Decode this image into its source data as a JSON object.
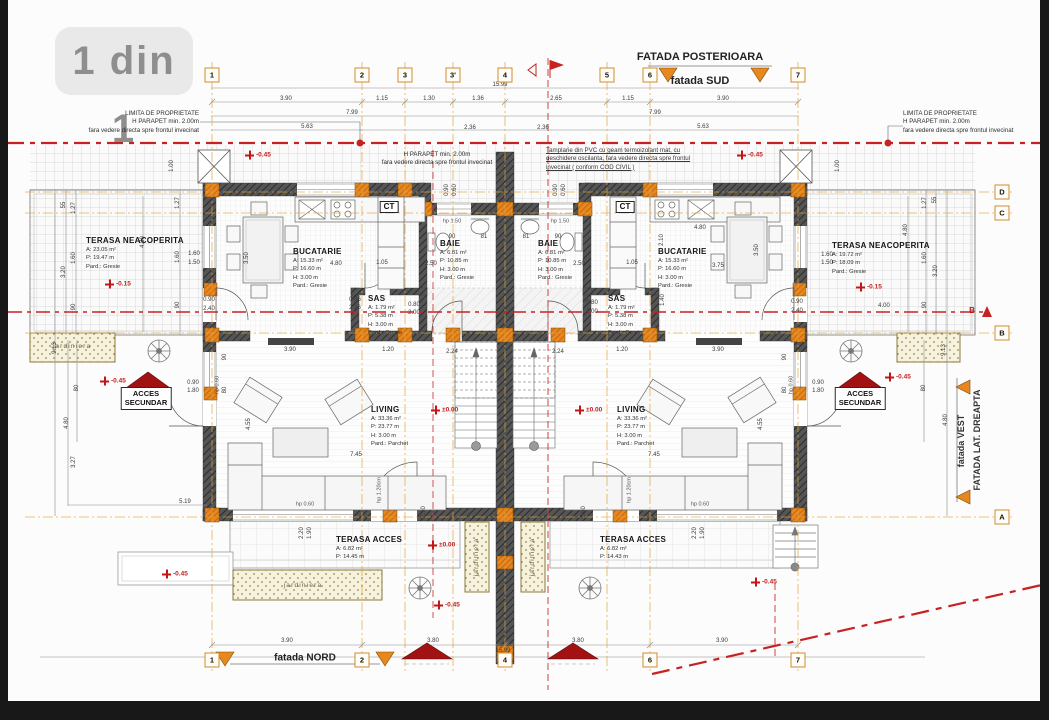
{
  "page": {
    "badge": "1 din 1"
  },
  "colors": {
    "accent_orange": "#e0821e",
    "wall_dark": "#4a4a4a",
    "red": "#c21616",
    "dark_red": "#a31212"
  },
  "facades": {
    "top_title": "FATADA POSTERIOARA",
    "top_sub": "fatada SUD",
    "bottom": "fatada NORD",
    "right_line1": "fatada VEST",
    "right_line2": "FATADA LAT. DREAPTA"
  },
  "notes": {
    "limita_left": [
      "LIMITA DE PROPRIETATE",
      "H PARAPET min. 2.00m",
      "fara vedere directa spre frontul invecinat"
    ],
    "limita_right": [
      "LIMITA DE PROPRIETATE",
      "H PARAPET min. 2.00m",
      "fara vedere directa spre frontul invecinat"
    ],
    "parapet_center": [
      "H PARAPET min. 2.00m",
      "fara vedere directa spre frontul invecinat"
    ],
    "pvc": [
      "Tamplarie din PVC cu geam termoizolant mat, cu",
      "deschidere oscilanta, fara vedere directa spre frontul",
      "invecinat ( conform COD CIVIL )"
    ]
  },
  "grid": {
    "top_y": 75,
    "bottom_y": 660,
    "rows_x": 1002,
    "cols_top": [
      {
        "label": "1",
        "x": 212
      },
      {
        "label": "2",
        "x": 362
      },
      {
        "label": "3",
        "x": 405
      },
      {
        "label": "3'",
        "x": 453
      },
      {
        "label": "4",
        "x": 505
      },
      {
        "label": "5",
        "x": 607
      },
      {
        "label": "6",
        "x": 650
      },
      {
        "label": "7",
        "x": 798
      }
    ],
    "cols_bottom": [
      {
        "label": "1",
        "x": 212
      },
      {
        "label": "2",
        "x": 362
      },
      {
        "label": "4",
        "x": 505
      },
      {
        "label": "6",
        "x": 650
      },
      {
        "label": "7",
        "x": 798
      }
    ],
    "rows": [
      {
        "label": "D",
        "y": 192
      },
      {
        "label": "C",
        "y": 213
      },
      {
        "label": "B",
        "y": 333
      },
      {
        "label": "A",
        "y": 517
      }
    ],
    "section_marker": {
      "t": "B",
      "x": 972,
      "y": 311
    }
  },
  "rooms": [
    {
      "name": "TERASA NEACOPERITA",
      "lines": [
        "A: 23.05 m²",
        "P: 19.47 m",
        "Pard.: Gresie"
      ],
      "x": 86,
      "y": 237
    },
    {
      "name": "BUCATARIE",
      "lines": [
        "A: 15.33 m²",
        "P: 16.60 m",
        "H: 3.00 m",
        "Pard.: Gresie"
      ],
      "x": 293,
      "y": 248
    },
    {
      "name": "SAS",
      "lines": [
        "A: 1.79 m²",
        "P: 5.38 m",
        "H: 3.00 m",
        "Pard.: Gresie"
      ],
      "x": 368,
      "y": 295
    },
    {
      "name": "BAIE",
      "lines": [
        "A: 6.81 m²",
        "P: 10.85 m",
        "H: 3.00 m",
        "Pard.: Gresie"
      ],
      "x": 440,
      "y": 240
    },
    {
      "name": "BAIE",
      "lines": [
        "A: 6.81 m²",
        "P: 10.85 m",
        "H: 3.00 m",
        "Pard.: Gresie"
      ],
      "x": 538,
      "y": 240
    },
    {
      "name": "SAS",
      "lines": [
        "A: 1.79 m²",
        "P: 5.38 m",
        "H: 3.00 m",
        "Pard.: Gresie"
      ],
      "x": 608,
      "y": 295
    },
    {
      "name": "BUCATARIE",
      "lines": [
        "A: 15.33 m²",
        "P: 16.60 m",
        "H: 3.00 m",
        "Pard.: Gresie"
      ],
      "x": 658,
      "y": 248
    },
    {
      "name": "TERASA NEACOPERITA",
      "lines": [
        "A: 19.72 m²",
        "P: 18.09 m",
        "Pard.: Gresie"
      ],
      "x": 832,
      "y": 242
    },
    {
      "name": "LIVING",
      "lines": [
        "A: 33.36 m²",
        "P: 23.77 m",
        "H: 3.00 m",
        "Pard.: Parchet"
      ],
      "x": 371,
      "y": 406
    },
    {
      "name": "LIVING",
      "lines": [
        "A: 33.36 m²",
        "P: 23.77 m",
        "H: 3.00 m",
        "Pard.: Parchet"
      ],
      "x": 617,
      "y": 406
    },
    {
      "name": "TERASA ACCES",
      "lines": [
        "A: 6.82 m²",
        "P: 14.45 m"
      ],
      "x": 336,
      "y": 536
    },
    {
      "name": "TERASA ACCES",
      "lines": [
        "A: 6.82 m²",
        "P: 14.43 m"
      ],
      "x": 600,
      "y": 536
    }
  ],
  "elevations": [
    {
      "t": "-0.45",
      "x": 245,
      "y": 155
    },
    {
      "t": "-0.45",
      "x": 737,
      "y": 155
    },
    {
      "t": "-0.15",
      "x": 105,
      "y": 284
    },
    {
      "t": "-0.15",
      "x": 856,
      "y": 287
    },
    {
      "t": "±0.00",
      "x": 431,
      "y": 410
    },
    {
      "t": "±0.00",
      "x": 575,
      "y": 410
    },
    {
      "t": "-0.45",
      "x": 100,
      "y": 381
    },
    {
      "t": "-0.45",
      "x": 885,
      "y": 377
    },
    {
      "t": "±0.00",
      "x": 428,
      "y": 545
    },
    {
      "t": "-0.45",
      "x": 162,
      "y": 574
    },
    {
      "t": "-0.45",
      "x": 434,
      "y": 605
    },
    {
      "t": "-0.45",
      "x": 751,
      "y": 582
    }
  ],
  "dims": [
    {
      "t": "15.99",
      "x": 500,
      "y": 85
    },
    {
      "t": "3.90",
      "x": 286,
      "y": 99
    },
    {
      "t": "1.15",
      "x": 382,
      "y": 99
    },
    {
      "t": "1.30",
      "x": 429,
      "y": 99
    },
    {
      "t": "1.36",
      "x": 478,
      "y": 99
    },
    {
      "t": "2.65",
      "x": 556,
      "y": 99
    },
    {
      "t": "1.15",
      "x": 628,
      "y": 99
    },
    {
      "t": "3.90",
      "x": 723,
      "y": 99
    },
    {
      "t": "7.99",
      "x": 352,
      "y": 113
    },
    {
      "t": "7.99",
      "x": 655,
      "y": 113
    },
    {
      "t": "5.63",
      "x": 307,
      "y": 127
    },
    {
      "t": "2.36",
      "x": 470,
      "y": 128
    },
    {
      "t": "2.36",
      "x": 543,
      "y": 128
    },
    {
      "t": "5.63",
      "x": 703,
      "y": 127
    },
    {
      "t": "3.90",
      "x": 287,
      "y": 641
    },
    {
      "t": "3.80",
      "x": 433,
      "y": 641
    },
    {
      "t": "3.80",
      "x": 578,
      "y": 641
    },
    {
      "t": "3.90",
      "x": 722,
      "y": 641
    },
    {
      "t": "15.99",
      "x": 503,
      "y": 651
    },
    {
      "t": "55",
      "x": 64,
      "y": 205,
      "r": 1
    },
    {
      "t": "1.27",
      "x": 74,
      "y": 208,
      "r": 1
    },
    {
      "t": "1.60",
      "x": 74,
      "y": 258,
      "r": 1
    },
    {
      "t": "3.20",
      "x": 64,
      "y": 272,
      "r": 1
    },
    {
      "t": "90",
      "x": 74,
      "y": 307,
      "r": 1
    },
    {
      "t": "1.00",
      "x": 172,
      "y": 166,
      "r": 1
    },
    {
      "t": "1.27",
      "x": 178,
      "y": 203,
      "r": 1
    },
    {
      "t": "1.60",
      "x": 178,
      "y": 257,
      "r": 1
    },
    {
      "t": "90",
      "x": 178,
      "y": 305,
      "r": 1
    },
    {
      "t": "4.80",
      "x": 143,
      "y": 242,
      "r": 1
    },
    {
      "t": "9.13",
      "x": 55,
      "y": 348,
      "r": 1
    },
    {
      "t": "80",
      "x": 77,
      "y": 388,
      "r": 1
    },
    {
      "t": "4.80",
      "x": 67,
      "y": 423,
      "r": 1
    },
    {
      "t": "3.27",
      "x": 74,
      "y": 462,
      "r": 1
    },
    {
      "t": "5.19",
      "x": 185,
      "y": 502
    },
    {
      "t": "0.90",
      "x": 193,
      "y": 383
    },
    {
      "t": "1.80",
      "x": 193,
      "y": 391
    },
    {
      "t": "1.60",
      "x": 194,
      "y": 254
    },
    {
      "t": "1.50",
      "x": 194,
      "y": 263
    },
    {
      "t": "0.90",
      "x": 209,
      "y": 300
    },
    {
      "t": "2.40",
      "x": 209,
      "y": 309
    },
    {
      "t": "1.00",
      "x": 838,
      "y": 166,
      "r": 1
    },
    {
      "t": "1.27",
      "x": 925,
      "y": 203,
      "r": 1
    },
    {
      "t": "55",
      "x": 935,
      "y": 200,
      "r": 1
    },
    {
      "t": "4.80",
      "x": 906,
      "y": 230,
      "r": 1
    },
    {
      "t": "1.60",
      "x": 925,
      "y": 258,
      "r": 1
    },
    {
      "t": "3.20",
      "x": 936,
      "y": 271,
      "r": 1
    },
    {
      "t": "90",
      "x": 925,
      "y": 305,
      "r": 1
    },
    {
      "t": "9.13",
      "x": 944,
      "y": 350,
      "r": 1
    },
    {
      "t": "80",
      "x": 924,
      "y": 388,
      "r": 1
    },
    {
      "t": "4.80",
      "x": 946,
      "y": 420,
      "r": 1
    },
    {
      "t": "1.60",
      "x": 827,
      "y": 255
    },
    {
      "t": "1.50",
      "x": 827,
      "y": 263
    },
    {
      "t": "0.90",
      "x": 797,
      "y": 302
    },
    {
      "t": "2.40",
      "x": 797,
      "y": 311
    },
    {
      "t": "0.90",
      "x": 818,
      "y": 383
    },
    {
      "t": "1.80",
      "x": 818,
      "y": 391
    },
    {
      "t": "4.00",
      "x": 884,
      "y": 306
    },
    {
      "t": "4.80",
      "x": 336,
      "y": 264
    },
    {
      "t": "3.50",
      "x": 247,
      "y": 258,
      "r": 1
    },
    {
      "t": "1.05",
      "x": 382,
      "y": 263
    },
    {
      "t": "4.80",
      "x": 700,
      "y": 228
    },
    {
      "t": "3.75",
      "x": 718,
      "y": 266
    },
    {
      "t": "3.50",
      "x": 757,
      "y": 250,
      "r": 1
    },
    {
      "t": "2.10",
      "x": 662,
      "y": 240,
      "r": 1
    },
    {
      "t": "1.40",
      "x": 663,
      "y": 300,
      "r": 1
    },
    {
      "t": "1.05",
      "x": 632,
      "y": 263
    },
    {
      "t": "0.86",
      "x": 355,
      "y": 300
    },
    {
      "t": "2.16",
      "x": 355,
      "y": 308
    },
    {
      "t": "0.80",
      "x": 414,
      "y": 305
    },
    {
      "t": "2.00",
      "x": 414,
      "y": 313
    },
    {
      "t": "0.80",
      "x": 592,
      "y": 303
    },
    {
      "t": "2.00",
      "x": 592,
      "y": 312
    },
    {
      "t": "90",
      "x": 452,
      "y": 237
    },
    {
      "t": "81",
      "x": 484,
      "y": 237
    },
    {
      "t": "81",
      "x": 526,
      "y": 237
    },
    {
      "t": "90",
      "x": 558,
      "y": 237
    },
    {
      "t": "2.50",
      "x": 431,
      "y": 264
    },
    {
      "t": "2.50",
      "x": 579,
      "y": 264
    },
    {
      "t": "3.90",
      "x": 290,
      "y": 350
    },
    {
      "t": "1.20",
      "x": 388,
      "y": 350
    },
    {
      "t": "2.24",
      "x": 452,
      "y": 352
    },
    {
      "t": "2.24",
      "x": 558,
      "y": 352
    },
    {
      "t": "1.20",
      "x": 622,
      "y": 350
    },
    {
      "t": "3.90",
      "x": 718,
      "y": 350
    },
    {
      "t": "90",
      "x": 225,
      "y": 357,
      "r": 1
    },
    {
      "t": "80",
      "x": 225,
      "y": 390,
      "r": 1
    },
    {
      "t": "4.55",
      "x": 249,
      "y": 424,
      "r": 1
    },
    {
      "t": "7.45",
      "x": 356,
      "y": 455
    },
    {
      "t": "7.45",
      "x": 654,
      "y": 455
    },
    {
      "t": "90",
      "x": 785,
      "y": 357,
      "r": 1
    },
    {
      "t": "80",
      "x": 785,
      "y": 390,
      "r": 1
    },
    {
      "t": "4.55",
      "x": 761,
      "y": 424,
      "r": 1
    },
    {
      "t": "2.10",
      "x": 424,
      "y": 512,
      "r": 1
    },
    {
      "t": "1.60",
      "x": 584,
      "y": 512,
      "r": 1
    },
    {
      "t": "2.20",
      "x": 302,
      "y": 533,
      "r": 1
    },
    {
      "t": "1.90",
      "x": 310,
      "y": 533,
      "r": 1
    },
    {
      "t": "2.20",
      "x": 695,
      "y": 533,
      "r": 1
    },
    {
      "t": "1.90",
      "x": 703,
      "y": 533,
      "r": 1
    },
    {
      "t": "0.90",
      "x": 556,
      "y": 190,
      "r": 1
    },
    {
      "t": "0.60",
      "x": 564,
      "y": 190,
      "r": 1
    },
    {
      "t": "0.90",
      "x": 447,
      "y": 190,
      "r": 1
    },
    {
      "t": "0.60",
      "x": 455,
      "y": 190,
      "r": 1
    }
  ],
  "hp_labels": [
    {
      "t": "hp 1.50",
      "x": 452,
      "y": 222
    },
    {
      "t": "hp 1.50",
      "x": 560,
      "y": 222
    },
    {
      "t": "hp 0.60",
      "x": 305,
      "y": 505
    },
    {
      "t": "hp 0.60",
      "x": 700,
      "y": 505
    },
    {
      "t": "hp 1.20cm",
      "x": 380,
      "y": 490,
      "r": 1
    },
    {
      "t": "hp 1.20cm",
      "x": 630,
      "y": 490,
      "r": 1
    },
    {
      "t": "hp 0.60",
      "x": 218,
      "y": 385,
      "r": 1
    },
    {
      "t": "hp 0.60",
      "x": 792,
      "y": 385,
      "r": 1
    }
  ],
  "jardiniere": [
    {
      "t": "jardiniera",
      "x": 72,
      "y": 347
    },
    {
      "t": "jardiniera",
      "x": 303,
      "y": 586
    },
    {
      "t": "jardiniera",
      "x": 477,
      "y": 557,
      "r": 1
    },
    {
      "t": "jardiniera",
      "x": 533,
      "y": 557,
      "r": 1
    }
  ],
  "ct_labels": [
    {
      "t": "CT",
      "x": 389,
      "y": 207
    },
    {
      "t": "CT",
      "x": 625,
      "y": 207
    }
  ],
  "acces_labels": [
    {
      "lines": [
        "ACCES",
        "SECUNDAR"
      ],
      "x": 146,
      "y": 387
    },
    {
      "lines": [
        "ACCES",
        "SECUNDAR"
      ],
      "x": 860,
      "y": 387
    }
  ]
}
